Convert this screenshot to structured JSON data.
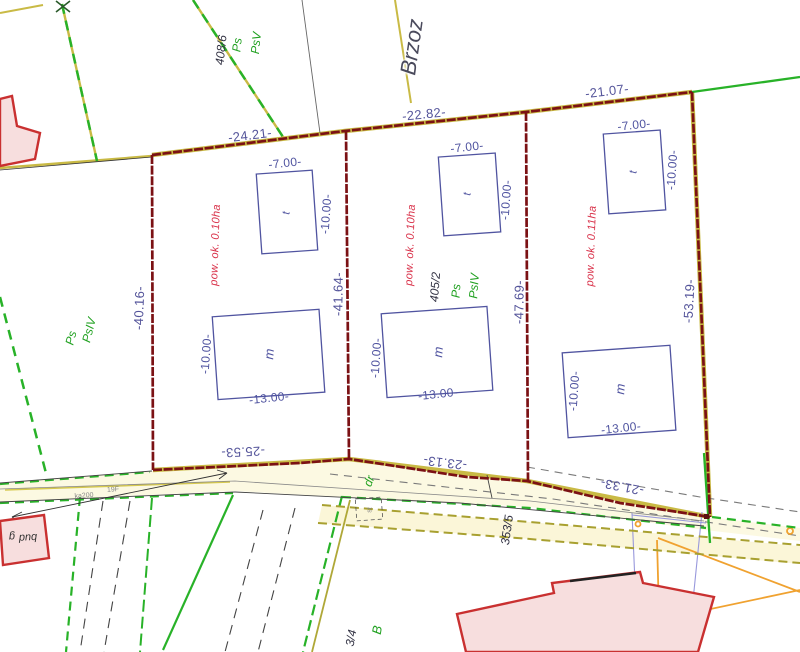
{
  "map": {
    "street": {
      "name": "Brzoz"
    },
    "parcels": {
      "p408_6": {
        "number": "408/6",
        "use_a": "Ps",
        "use_b": "PsV"
      },
      "left_area": {
        "use_a": "Ps",
        "use_b": "PsIV"
      },
      "p405_2": {
        "number": "405/2",
        "use_a": "Ps",
        "use_b": "PsIV"
      },
      "road_parcel": {
        "number": "353/5"
      },
      "bottom_parcel": {
        "number": "3/4",
        "use": "B"
      },
      "road_label": "dr"
    },
    "areas": {
      "plot1": "pow. ok. 0.10ha",
      "plot2": "pow. ok. 0.10ha",
      "plot3": "pow. ok. 0.11ha"
    },
    "dimensions": {
      "top_1": "-24.21-",
      "top_2": "-22.82-",
      "top_3": "-21.07-",
      "bottom_1": "-25.53-",
      "bottom_2": "-23.13-",
      "bottom_3": "-21.33-",
      "left": "-40.16-",
      "mid_1": "-41.64-",
      "mid_2": "-47.69-",
      "right": "-53.19-",
      "bldg_w7": "-7.00-",
      "bldg_h10": "-10.00-",
      "bldg_w13": "-13.00-"
    },
    "building_codes": {
      "t": "t",
      "m": "m",
      "g": "g",
      "bud": "bud",
      "st": "st"
    },
    "utility_labels": {
      "ka": "ka200",
      "f": "19F"
    },
    "colors": {
      "boundary_maroon": "#7b1114",
      "dimension_text": "#54549a",
      "area_text": "#d9324a",
      "green_label": "#21a121",
      "green_line": "#28b228",
      "yellow_line": "#c9ba45",
      "olive_dashed": "#a8a030",
      "orange_line": "#f0a230",
      "violet_line": "#9898dc",
      "building_outline": "#5054a0",
      "red_building": "#c93030",
      "red_building_fill": "#f7dede",
      "road_fill": "#fcf9e2"
    }
  }
}
